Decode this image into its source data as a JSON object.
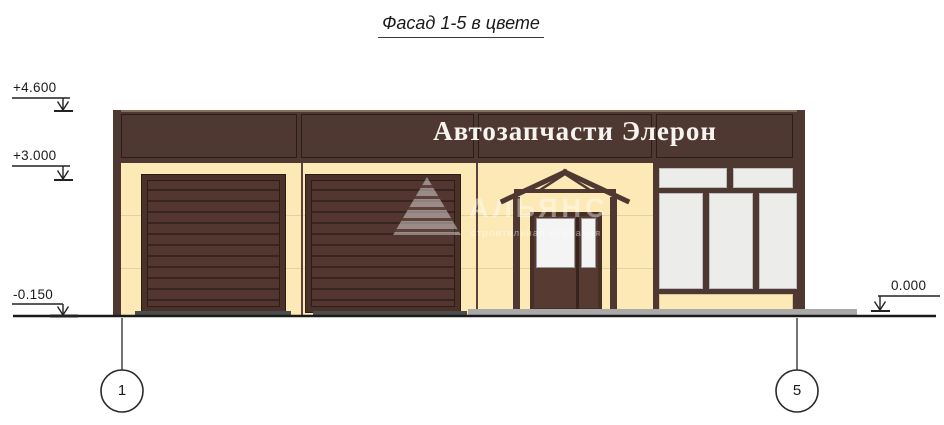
{
  "title": "Фасад 1-5 в цвете",
  "sign": "Автозапчасти Элерон",
  "levels": {
    "roof": "+4.600",
    "band": "+3.000",
    "base": "-0.150",
    "ground": "0.000"
  },
  "axes": {
    "left": "1",
    "right": "5"
  },
  "watermark": {
    "name": "АЛЬЯНС",
    "subtitle": "строительная компания"
  },
  "colors": {
    "brown": "#4e3831",
    "cream": "#fce9b5",
    "slat": "#53362f",
    "slat_line": "#382420",
    "glass": "#ececea",
    "door_glass": "#f4f4f4",
    "joint": "#e2d1a2",
    "apron_dark": "#4c4c4c",
    "apron_light": "#a9a9a9",
    "sign_text": "#f7f4f0",
    "line": "#1a1a1a"
  }
}
